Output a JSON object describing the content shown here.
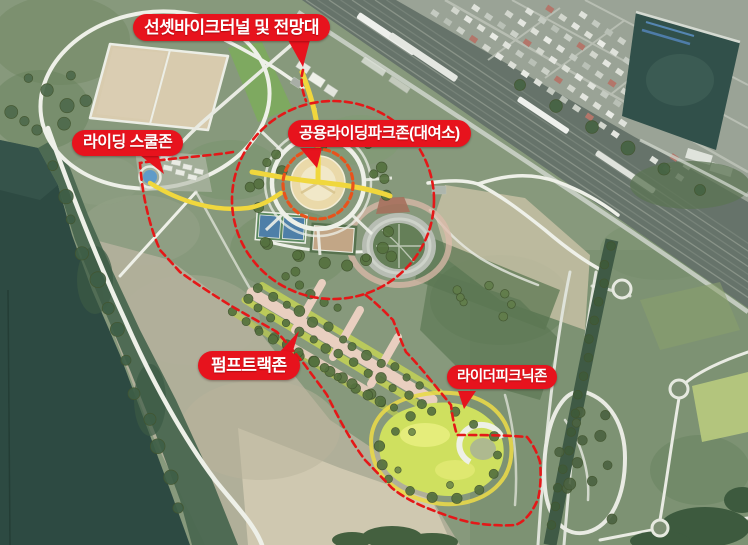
{
  "map": {
    "description": "Aerial satellite view of a riverside park with bike-park zone annotations",
    "callouts": [
      {
        "id": "sunset-bike-tunnel",
        "label": "선셋바이크터널 및 전망대"
      },
      {
        "id": "riding-school-zone",
        "label": "라이딩 스쿨존"
      },
      {
        "id": "public-riding-park-zone",
        "label": "공용라이딩파크존(대여소)"
      },
      {
        "id": "pump-track-zone",
        "label": "펌프트랙존"
      },
      {
        "id": "rider-picnic-zone",
        "label": "라이더피크닉존"
      }
    ],
    "colors": {
      "callout_bg": "#e7131d",
      "callout_text": "#ffffff",
      "boundary_dash": "#e41818",
      "plaza_ring_dash": "#e8531c",
      "yellow_path": "#f0d73d",
      "river": "#2d4a42",
      "meadow": "#cfe05f"
    }
  }
}
